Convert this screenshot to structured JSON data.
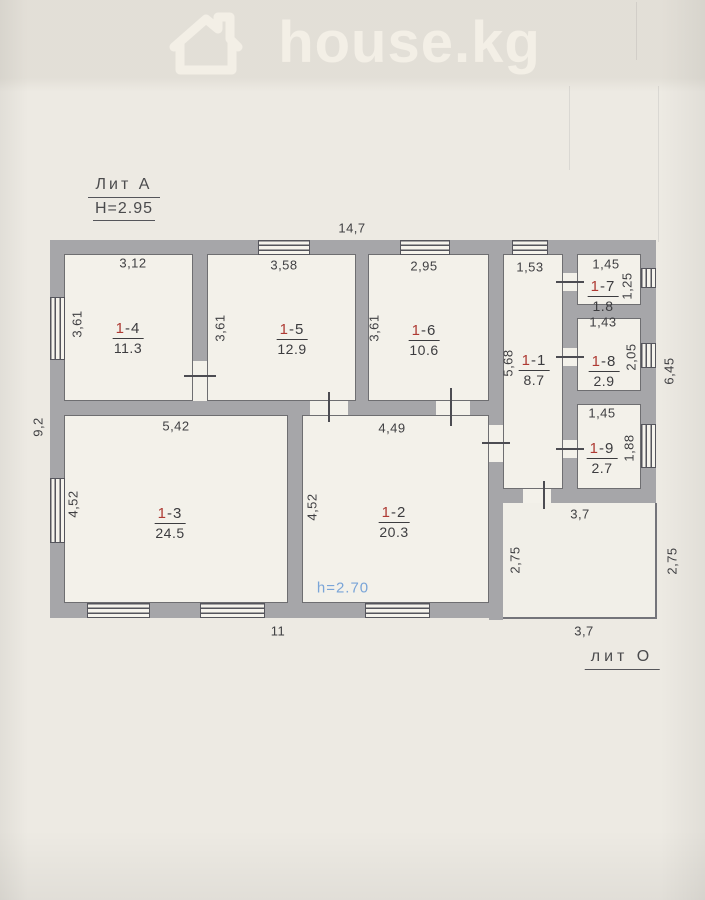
{
  "watermark": {
    "brand": "house.kg",
    "icon": "house-outline-icon"
  },
  "title_block": {
    "building_label": "Лит А",
    "height_label": "H=2.95"
  },
  "annex": {
    "label": "лит О"
  },
  "ceiling_height_note": "h=2.70",
  "rooms": [
    {
      "id": "1-4",
      "area": "11.3"
    },
    {
      "id": "1-5",
      "area": "12.9"
    },
    {
      "id": "1-6",
      "area": "10.6"
    },
    {
      "id": "1-1",
      "area": "8.7"
    },
    {
      "id": "1-7",
      "area": "1.8"
    },
    {
      "id": "1-8",
      "area": "2.9"
    },
    {
      "id": "1-9",
      "area": "2.7"
    },
    {
      "id": "1-3",
      "area": "24.5"
    },
    {
      "id": "1-2",
      "area": "20.3"
    }
  ],
  "dimensions": [
    {
      "text": "14,7"
    },
    {
      "text": "3,12"
    },
    {
      "text": "3,58"
    },
    {
      "text": "2,95"
    },
    {
      "text": "1,53"
    },
    {
      "text": "1,45"
    },
    {
      "text": "1,25"
    },
    {
      "text": "3,61"
    },
    {
      "text": "3,61"
    },
    {
      "text": "3,61"
    },
    {
      "text": "5,68"
    },
    {
      "text": "1,43"
    },
    {
      "text": "2,05"
    },
    {
      "text": "6,45"
    },
    {
      "text": "1,45"
    },
    {
      "text": "1,88"
    },
    {
      "text": "9,2"
    },
    {
      "text": "5,42"
    },
    {
      "text": "4,49"
    },
    {
      "text": "4,52"
    },
    {
      "text": "4,52"
    },
    {
      "text": "2,75"
    },
    {
      "text": "2,75"
    },
    {
      "text": "3,7"
    },
    {
      "text": "3,7"
    },
    {
      "text": "11"
    }
  ],
  "colors": {
    "wall_gray": "#a6a6a9",
    "room_number_red": "#ae3a33",
    "height_note_blue": "#7aa5d8",
    "paper": "#edeae3"
  }
}
